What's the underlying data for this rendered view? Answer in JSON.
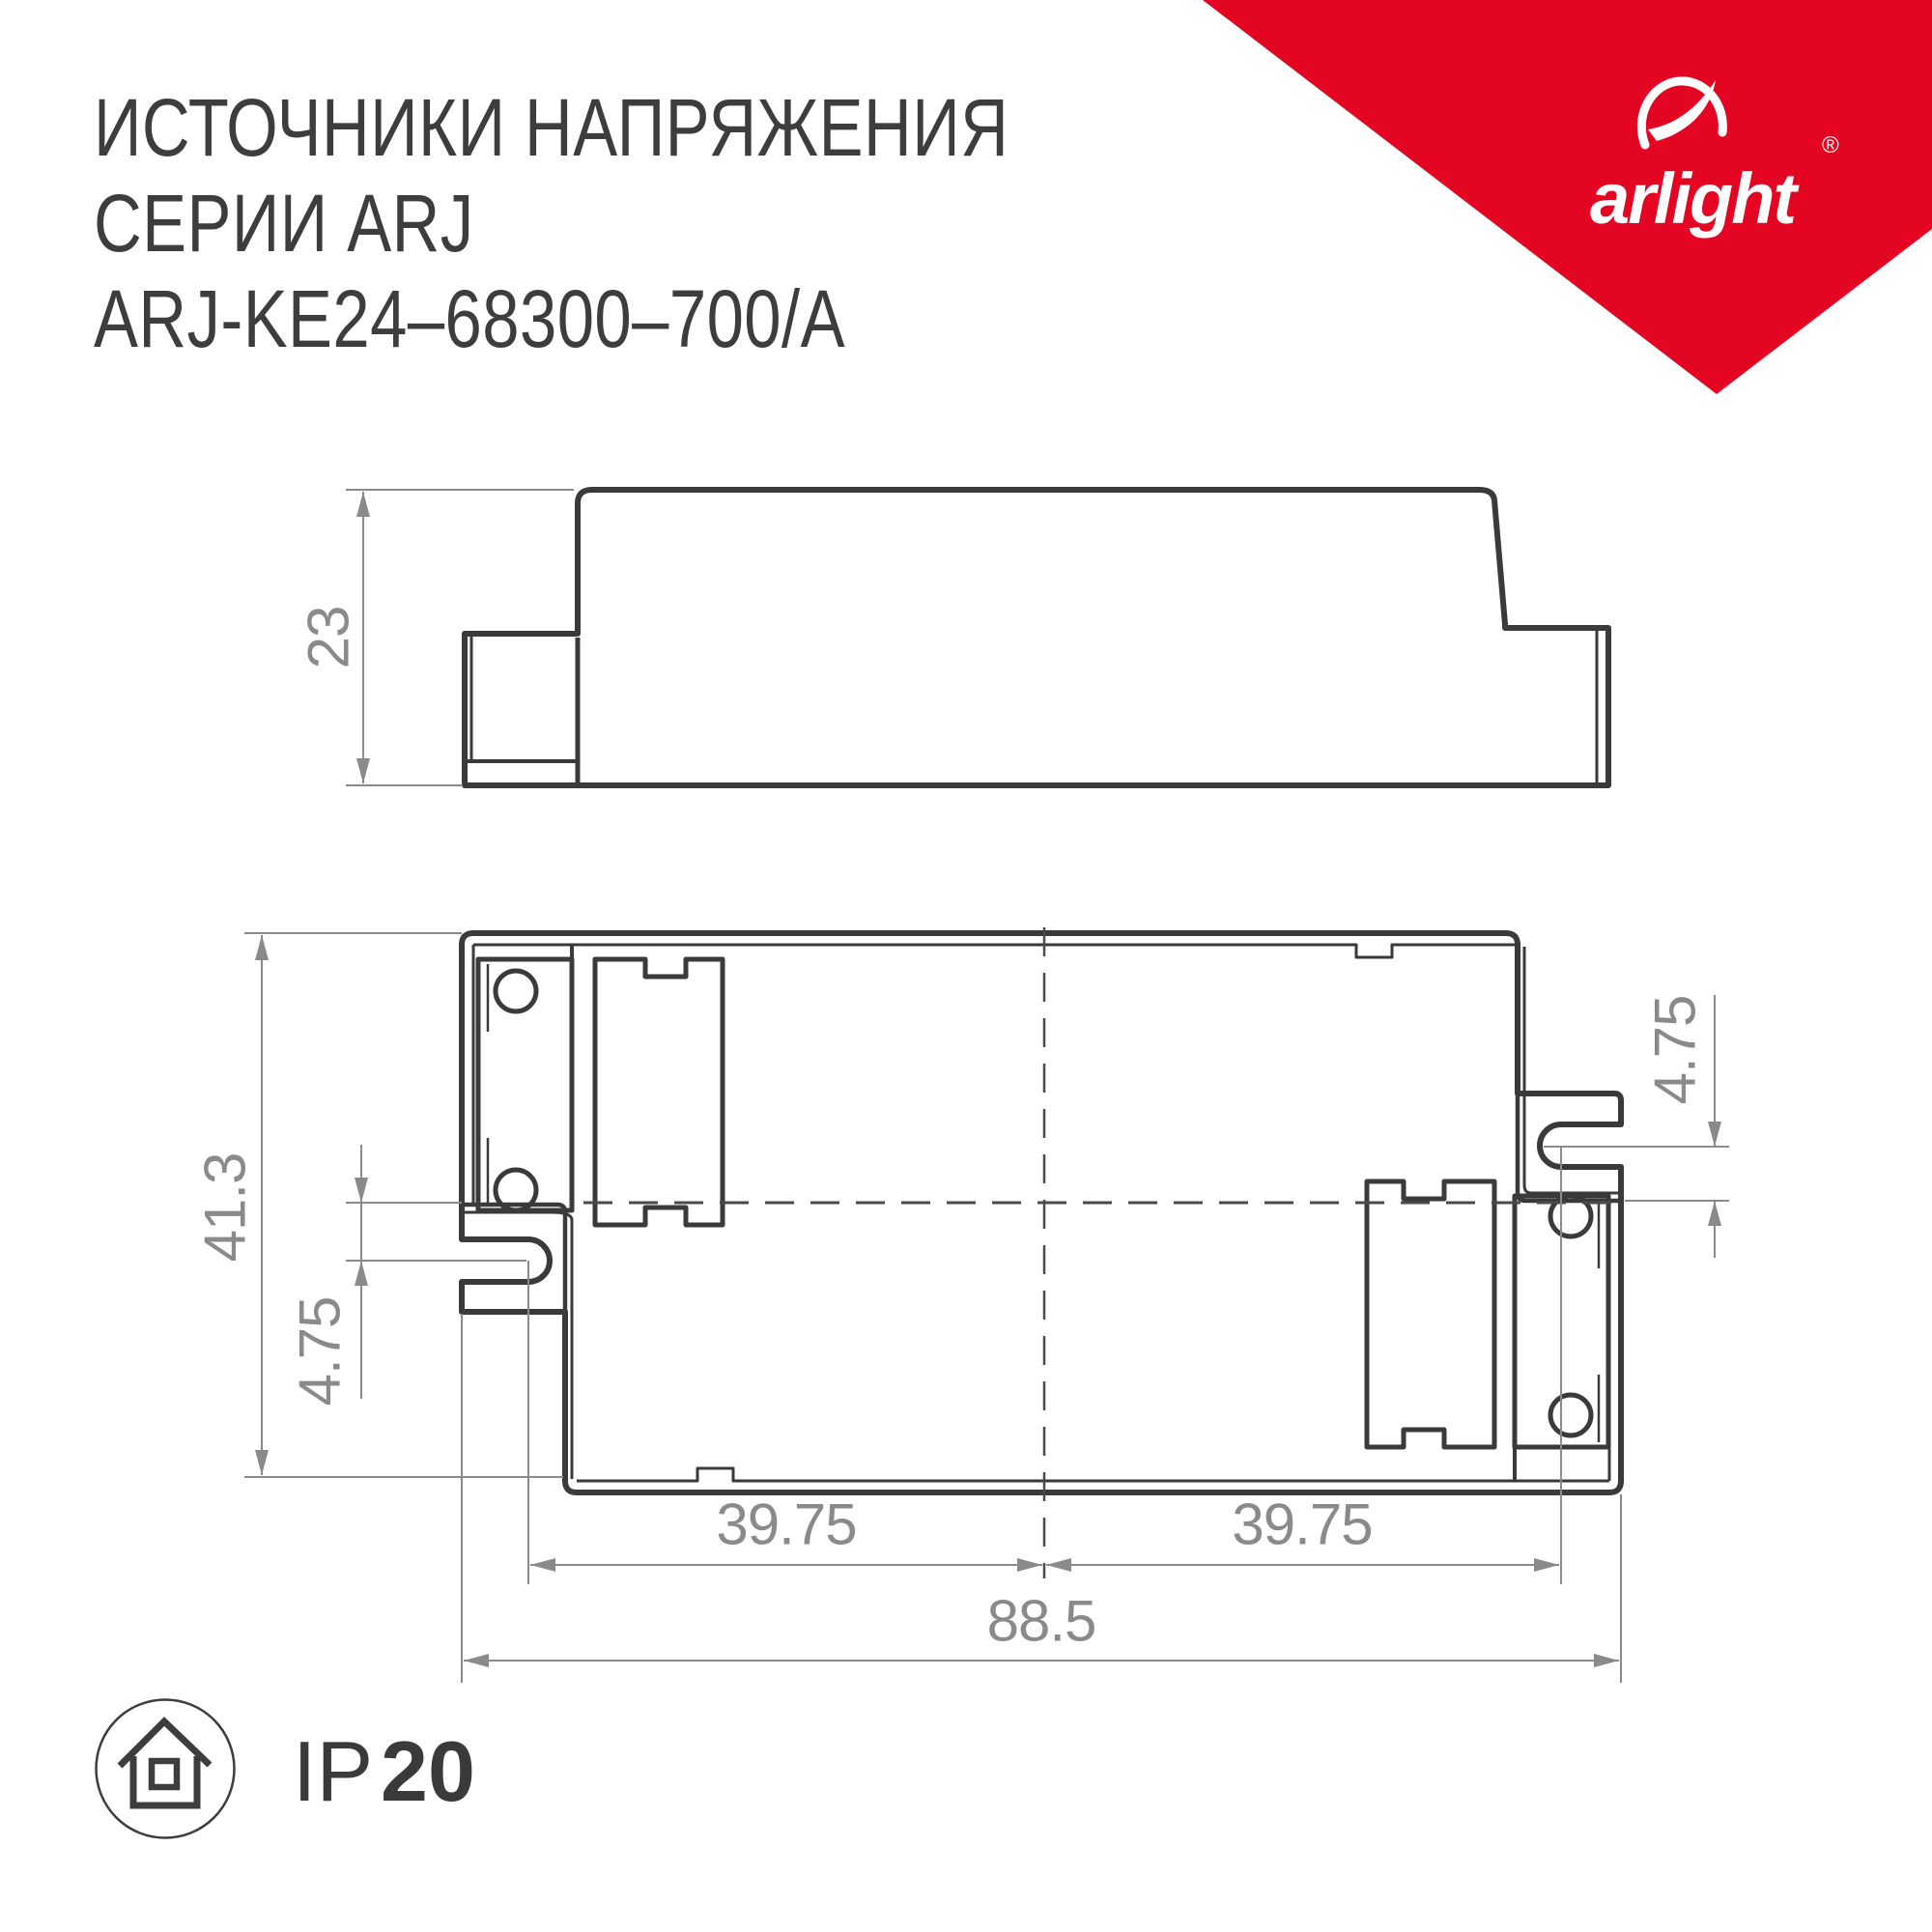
{
  "header": {
    "title_line1": "ИСТОЧНИКИ НАПРЯЖЕНИЯ",
    "title_line2": "СЕРИИ ARJ",
    "title_line3": "ARJ-KE24–68300–700/A"
  },
  "brand": {
    "name": "arlight",
    "registered": "®",
    "banner_color": "#e30522"
  },
  "side_view": {
    "height_dim": "23"
  },
  "top_view": {
    "height_dim": "41.3",
    "left_offset_dim": "4.75",
    "right_offset_dim": "4.75",
    "left_span_dim": "39.75",
    "right_span_dim": "39.75",
    "overall_width_dim": "88.5"
  },
  "footer": {
    "ip_label_prefix": "IP",
    "ip_label_value": "20"
  },
  "colors": {
    "line": "#3a3a3a",
    "dimension": "#8a8a8a",
    "background": "#ffffff"
  }
}
